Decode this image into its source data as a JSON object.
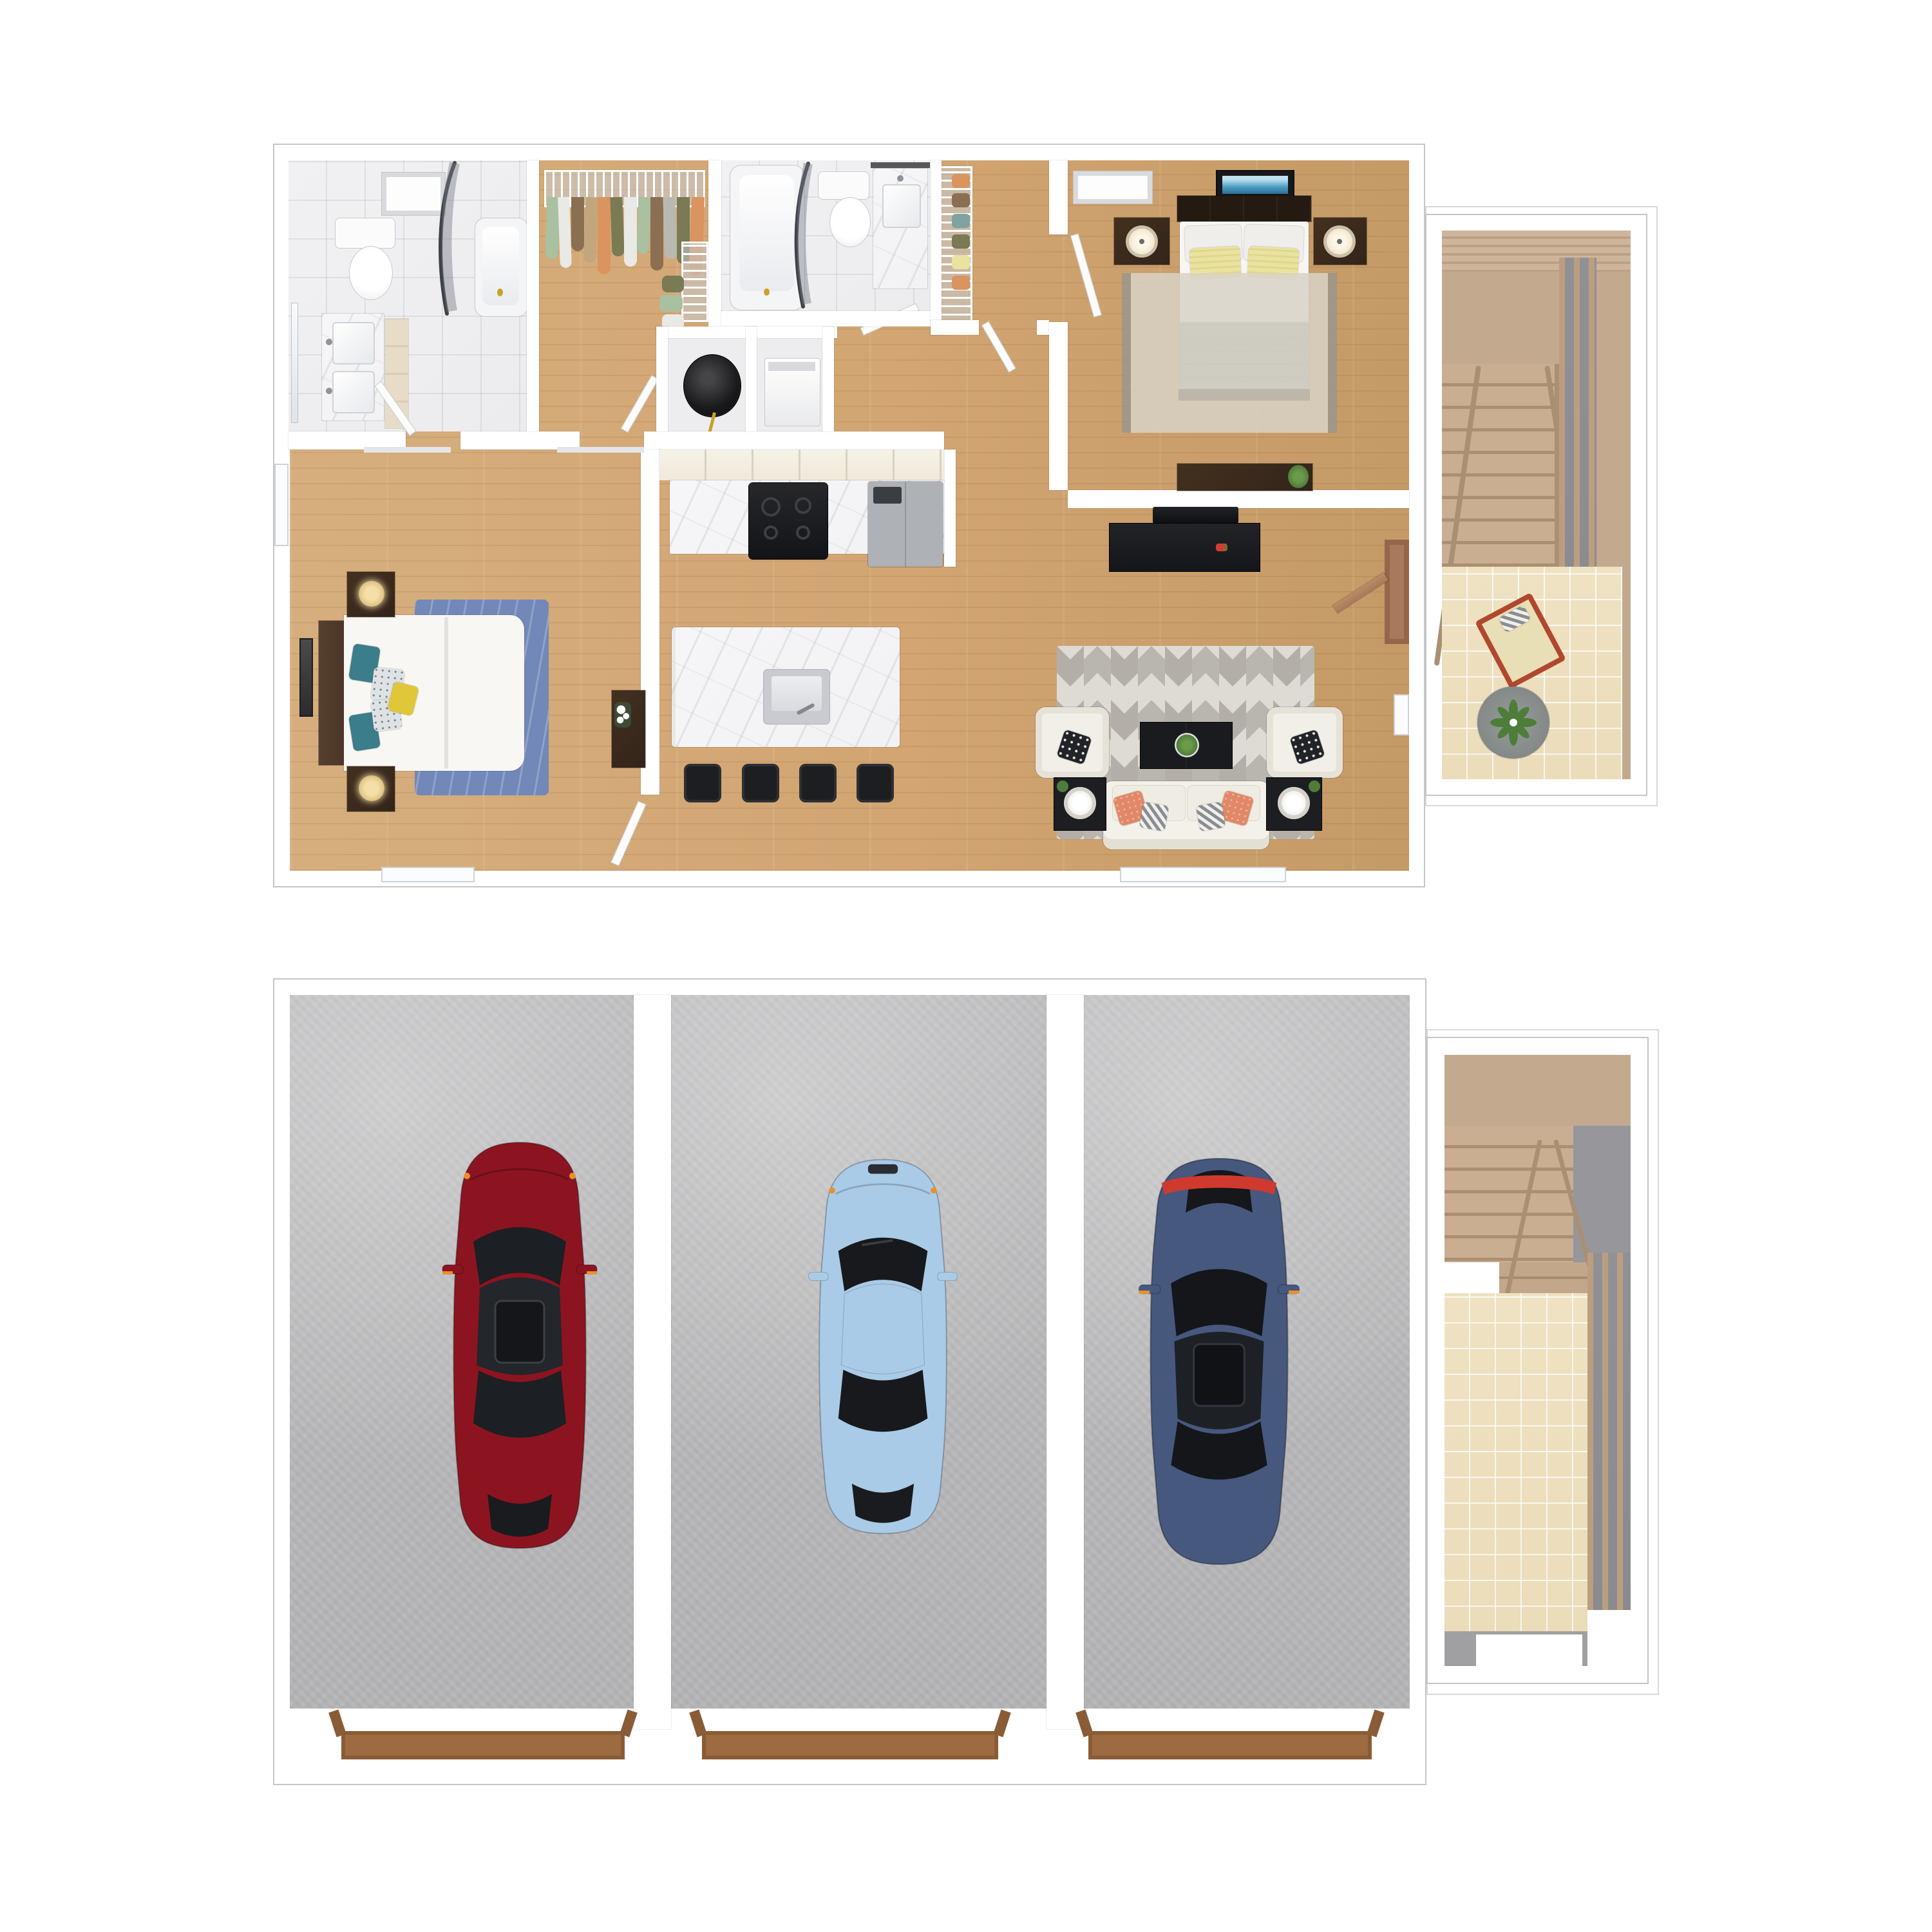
{
  "scene": {
    "type": "3d-floor-plan-render",
    "views": [
      "main living level",
      "garage level"
    ],
    "background": "#ffffff",
    "visible_text": []
  },
  "colors": {
    "wall": "#ffffff",
    "wall-line": "#c6c6c6",
    "wood": "#d6ae7e",
    "wood-dark": "#c49a66",
    "tile": "#ececee",
    "marble": "#f2f2f4",
    "beige-tile": "#ebdcba",
    "concrete": "#bcbcbe",
    "tan-wall": "#c3a98e",
    "stair-wood": "#c9ae92",
    "stair-tread-dark": "#ab8f72",
    "slat-wood": "#bb9e80",
    "dark-wood": "#33241a",
    "espresso": "#1d1e22",
    "gray-duvet": "#9aa1a8",
    "navy-rug": "#7288b8",
    "cream-rug": "#d8d3c6",
    "chevron-light": "#dedbd5",
    "chevron-dark": "#b3afa8",
    "coral": "#e08868",
    "teal": "#3b7d8a",
    "yellow-pillow": "#e0c73a",
    "pale-yellow": "#eae3a0",
    "art-blue": "#4f9fc7",
    "door-wood": "#a8795a",
    "gold": "#c9a227",
    "plant": "#4e7d3a",
    "car-red": "#8c1420",
    "car-blue": "#a9cbe7",
    "car-navy": "#47587e",
    "tail-red": "#d03a2e",
    "mirror-orange": "#e8902e",
    "threshold": "#9c6b42",
    "lamp-warm": "#f5dfa8",
    "clothes-1": "#a9c0a1",
    "clothes-2": "#e9e9e6",
    "clothes-3": "#c2a77d",
    "clothes-4": "#7a7a54",
    "clothes-5": "#d9945f",
    "clothes-6": "#8a6f52",
    "clothes-7": "#b9b9b3"
  },
  "main_floor": {
    "label": "Main level floor plan",
    "rooms": [
      {
        "id": "master-bathroom",
        "label": "Master bathroom",
        "items": [
          "double-sink vanity",
          "mirror",
          "toilet",
          "bathtub",
          "curved shower curtain",
          "skylight",
          "linen cabinet",
          "door"
        ]
      },
      {
        "id": "walk-in-closet",
        "label": "Walk-in closet",
        "items": [
          "wire shelf",
          "hanging clothes",
          "wire drawer tower",
          "clothes pile"
        ]
      },
      {
        "id": "bathroom-2",
        "label": "Bathroom 2",
        "items": [
          "bathtub",
          "curved shower curtain",
          "toilet",
          "vanity with mirror"
        ]
      },
      {
        "id": "linen-closet",
        "label": "Linen / shoe closet",
        "items": [
          "wire shelving",
          "shoes"
        ]
      },
      {
        "id": "utility-closet",
        "label": "Utility closet",
        "items": [
          "water heater"
        ]
      },
      {
        "id": "laundry-closet",
        "label": "Laundry closet",
        "items": [
          "washer"
        ]
      },
      {
        "id": "bedroom-2",
        "label": "Bedroom 2",
        "items": [
          "bed with gray duvet",
          "2 yellow pillows",
          "headboard",
          "2 nightstands",
          "2 lamps",
          "blue wall art",
          "skylight",
          "area rug",
          "desk with plant"
        ]
      },
      {
        "id": "master-bedroom",
        "label": "Master bedroom",
        "items": [
          "bed",
          "brown headboard",
          "teal and yellow pillows",
          "blue area rug",
          "2 nightstands",
          "2 lamps",
          "wall art",
          "dresser with flowers",
          "window"
        ]
      },
      {
        "id": "kitchen",
        "label": "Kitchen",
        "items": [
          "upper cabinets",
          "marble counter",
          "range with burners",
          "refrigerator",
          "island with sink",
          "4 bar stools"
        ]
      },
      {
        "id": "living-room",
        "label": "Living room",
        "items": [
          "TV",
          "media console",
          "chevron area rug",
          "2 armchairs",
          "black dot pillows",
          "coffee table with plant",
          "sofa",
          "2 coral pillows",
          "2 striped pillows",
          "2 end tables",
          "2 round lamps",
          "entry door",
          "windows"
        ]
      },
      {
        "id": "stair-landing-upper",
        "label": "Stairwell and landing",
        "items": [
          "wood staircase",
          "handrail",
          "balusters",
          "tile landing",
          "chaise lounge",
          "round rug",
          "plant"
        ]
      }
    ]
  },
  "garage_floor": {
    "label": "Garage level floor plan",
    "bays": 3,
    "garage_doors": 3,
    "cars": [
      {
        "id": "car-red",
        "label": "dark red sedan",
        "bay": 1
      },
      {
        "id": "car-light-blue",
        "label": "light blue sedan",
        "bay": 2
      },
      {
        "id": "car-navy",
        "label": "navy blue sedan",
        "bay": 3
      }
    ],
    "rooms": [
      {
        "id": "stair-landing-garage",
        "label": "Garage stairwell",
        "items": [
          "wood staircase",
          "handrail",
          "wood slat screen",
          "tile landing",
          "doorway"
        ]
      }
    ]
  }
}
